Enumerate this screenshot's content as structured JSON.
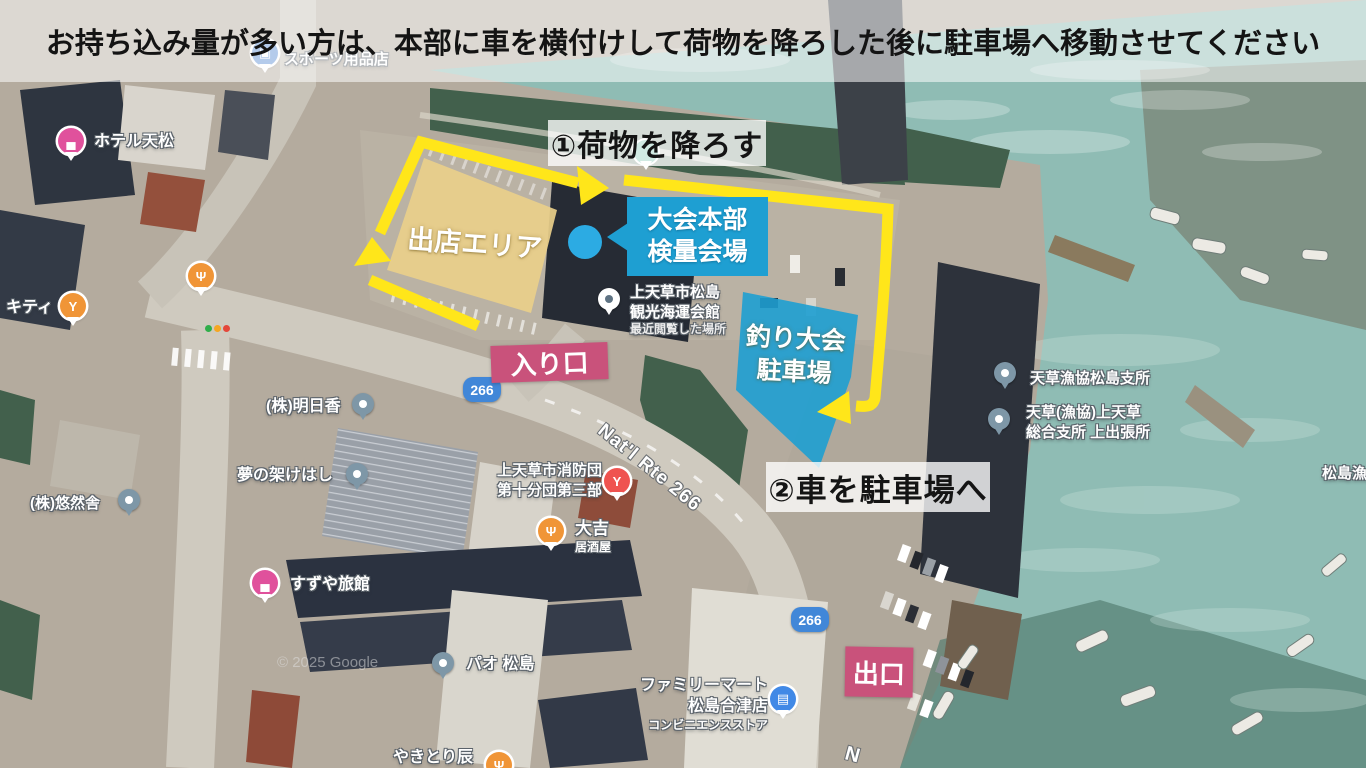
{
  "banner": {
    "text": "お持ち込み量が多い方は、本部に車を横付けして荷物を降ろした後に駐車場へ移動させてください"
  },
  "overlay": {
    "step1": "①荷物を降ろす",
    "step2": "②車を駐車場へ",
    "vendor_area": "出店エリア",
    "hq_line1": "大会本部",
    "hq_line2": "検量会場",
    "parking_line1": "釣り大会",
    "parking_line2": "駐車場",
    "entrance": "入り口",
    "exit": "出口"
  },
  "map": {
    "route_266": "266",
    "natl_rte": "Nat'l Rte 266",
    "partial_road_letter": "N",
    "copyright": "© 2025 Google",
    "pois": {
      "hotel_tenmatsu": {
        "name": "ホテル天松",
        "icon": "▄"
      },
      "sports_store": {
        "name": "スポーツ用品店",
        "icon": "▣"
      },
      "kitty": {
        "name": "キティ",
        "icon": "Y"
      },
      "noname_restaurant": {
        "icon": "Ψ"
      },
      "asuka": {
        "name": "(株)明日香"
      },
      "yume_no_kakehashi": {
        "name": "夢の架けはし"
      },
      "yuzensha": {
        "name": "(株)悠然舎"
      },
      "suzuya": {
        "name": "すずや旅館",
        "icon": "▄"
      },
      "fire_brigade": {
        "line1": "上天草市消防団",
        "line2": "第十分団第三部",
        "icon": "Y"
      },
      "daikichi": {
        "name": "大吉",
        "sub": "居酒屋",
        "icon": "Ψ"
      },
      "pao_matsushima": {
        "name": "パオ 松島"
      },
      "familymart": {
        "line1": "ファミリーマート",
        "line2": "松島合津店",
        "line3": "コンビニエンスストア",
        "icon": "▤"
      },
      "kaiun_kaikan": {
        "line1": "上天草市松島",
        "line2": "観光海運会館",
        "line3": "最近閲覧した場所"
      },
      "gyokyo_matsushima": {
        "name": "天草漁協松島支所"
      },
      "gyokyo_kamiamakusa": {
        "line1": "天草(漁協)上天草",
        "line2": "総合支所 上出張所"
      },
      "matsushima_port": {
        "name": "松島漁港"
      },
      "yakitori_tatsu": {
        "name": "やきとり辰",
        "icon": "Ψ"
      }
    }
  },
  "colors": {
    "arrow-yellow": "#ffe61a",
    "annot-blue": "#1e9fd2",
    "vendor-tan": "#e9cf8a",
    "annot-pink": "#c9527b",
    "dot-blue": "#2cabe3",
    "banner-bg": "rgba(253,253,253,0.55)",
    "banner-text": "#141414"
  }
}
